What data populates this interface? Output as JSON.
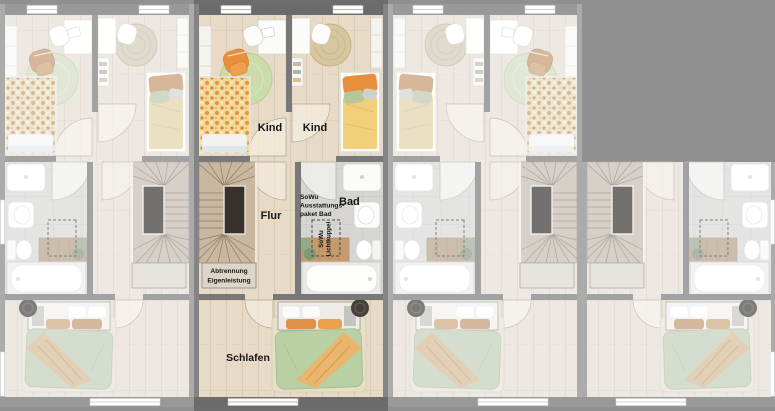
{
  "floorplan": {
    "title": "Reihenhaus Grundriss",
    "unit_count": 4,
    "highlighted_unit": 2,
    "rooms": {
      "kind_left": "Kind",
      "kind_right": "Kind",
      "flur": "Flur",
      "bad": "Bad",
      "schlafen": "Schlafen"
    },
    "annotations": {
      "bad_paket": {
        "line1": "SoWu",
        "line2": "Ausstattungs-",
        "line3": "paket Bad"
      },
      "lichtkuppel": {
        "line1": "SoWu",
        "line2": "Lichtkuppel"
      },
      "abtrennung": {
        "line1": "Abtrennung",
        "line2": "Eigenleistung"
      }
    },
    "colors": {
      "background": "#6d6d6d",
      "wall_dark": "#6b6b6b",
      "wall_party": "#848484",
      "wall_interior": "#787878",
      "wood_floor": "#e7dbc7",
      "bath_floor": "#d6d5d3",
      "stair_wood": "#c9b7a0",
      "rug_green": "#cbdcaa",
      "rug_jute": "#d8c69e",
      "bed_green": "#b9cfa4",
      "accent_orange": "#e88f3c",
      "blanket_yellow": "#f1cf7b",
      "label_text": "#161616"
    }
  }
}
